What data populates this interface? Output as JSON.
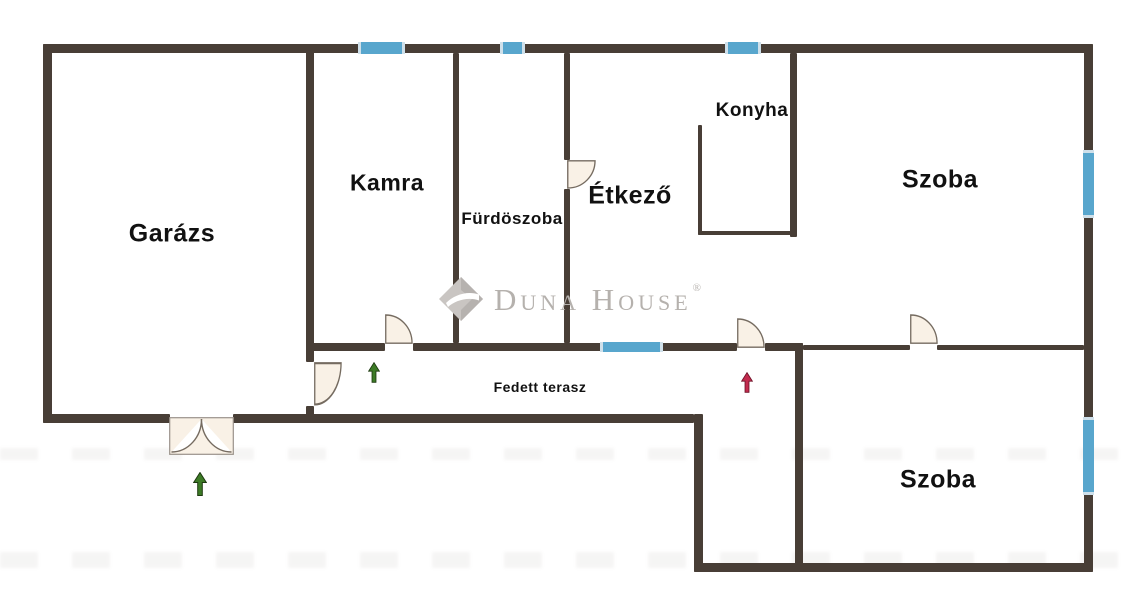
{
  "plan_type": "floor-plan",
  "rooms": {
    "garazs": "Garázs",
    "kamra": "Kamra",
    "furdoszoba": "Fürdöszoba",
    "etkezo": "Étkező",
    "konyha": "Konyha",
    "szoba_felso": "Szoba",
    "szoba_also": "Szoba",
    "fedett_terasz": "Fedett terasz"
  },
  "watermark": {
    "brand": "Duna House",
    "registered_mark": "®"
  },
  "colors": {
    "wall": "#483e36",
    "window": "#58a6cd",
    "window_cap": "#cfe0ea",
    "door_fill": "#f9f1e6",
    "door_outline": "#756b60",
    "entrance_arrow_green": "#3d7b26",
    "entrance_arrow_red": "#c22b4e",
    "label_text": "#111111",
    "watermark_gray": "#b5b1ad",
    "background": "#ffffff"
  },
  "features": {
    "windows": [
      {
        "name": "window-kamra-north",
        "wall": "north"
      },
      {
        "name": "window-furdoszoba-north",
        "wall": "north"
      },
      {
        "name": "window-konyha-north",
        "wall": "north"
      },
      {
        "name": "window-szoba-felso-east",
        "wall": "east"
      },
      {
        "name": "window-szoba-also-east",
        "wall": "east"
      },
      {
        "name": "window-fedett-terasz",
        "wall": "terrace"
      }
    ],
    "doors": [
      {
        "name": "furdoszoba-door",
        "type": "single-swing"
      },
      {
        "name": "kamra-door",
        "type": "single-swing"
      },
      {
        "name": "main-entrance-door",
        "type": "single-swing"
      },
      {
        "name": "szoba-connecting-door",
        "type": "single-swing"
      },
      {
        "name": "garazs-terasz-door",
        "type": "single-swing"
      },
      {
        "name": "garazs-gate",
        "type": "double-swing"
      }
    ],
    "entrance_arrows": [
      {
        "name": "garazs-entrance-arrow",
        "color": "green",
        "direction": "up"
      },
      {
        "name": "terasz-kamra-entrance-arrow",
        "color": "green",
        "direction": "up"
      },
      {
        "name": "main-entrance-arrow",
        "color": "red",
        "direction": "up"
      }
    ]
  }
}
